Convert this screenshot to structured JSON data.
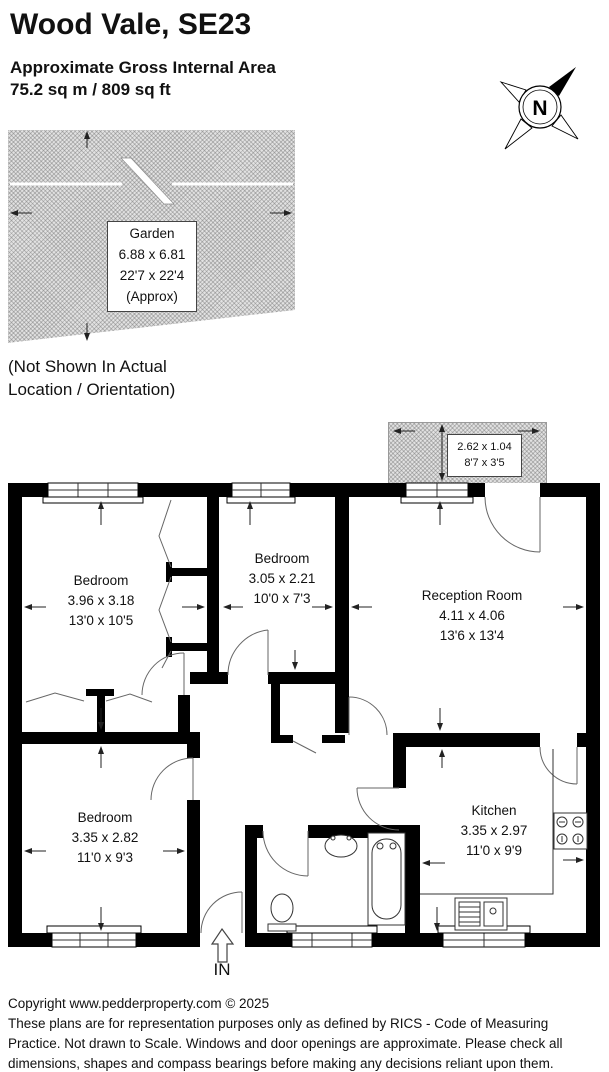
{
  "header": {
    "title": "Wood Vale, SE23",
    "area_label": "Approximate Gross Internal Area",
    "area_value": "75.2 sq m / 809 sq ft"
  },
  "compass": {
    "north_label": "N"
  },
  "garden": {
    "name": "Garden",
    "size_metric": "6.88 x 6.81",
    "size_imperial": "22'7 x 22'4",
    "approx_label": "(Approx)",
    "note_line1": "(Not Shown In Actual",
    "note_line2": "Location / Orientation)"
  },
  "floorplan": {
    "balcony": {
      "size_metric": "2.62 x 1.04",
      "size_imperial": "8'7 x 3'5"
    },
    "rooms": [
      {
        "name": "Bedroom",
        "size_metric": "3.96 x 3.18",
        "size_imperial": "13'0 x 10'5"
      },
      {
        "name": "Bedroom",
        "size_metric": "3.05 x 2.21",
        "size_imperial": "10'0 x 7'3"
      },
      {
        "name": "Reception Room",
        "size_metric": "4.11 x 4.06",
        "size_imperial": "13'6 x 13'4"
      },
      {
        "name": "Bedroom",
        "size_metric": "3.35 x 2.82",
        "size_imperial": "11'0 x 9'3"
      },
      {
        "name": "Kitchen",
        "size_metric": "3.35 x 2.97",
        "size_imperial": "11'0 x 9'9"
      }
    ],
    "entrance_label": "IN"
  },
  "footer": {
    "copyright": "Copyright www.pedderproperty.com © 2025",
    "disclaimer_lines": [
      "These plans are for representation purposes only as defined by RICS - Code of Measuring",
      "Practice. Not drawn to Scale. Windows and door openings are approximate. Please check all",
      "dimensions, shapes and compass bearings before making any decisions reliant upon them."
    ]
  },
  "colors": {
    "wall": "#000000",
    "garden_fill": "#e2e2e2",
    "text": "#111111"
  }
}
